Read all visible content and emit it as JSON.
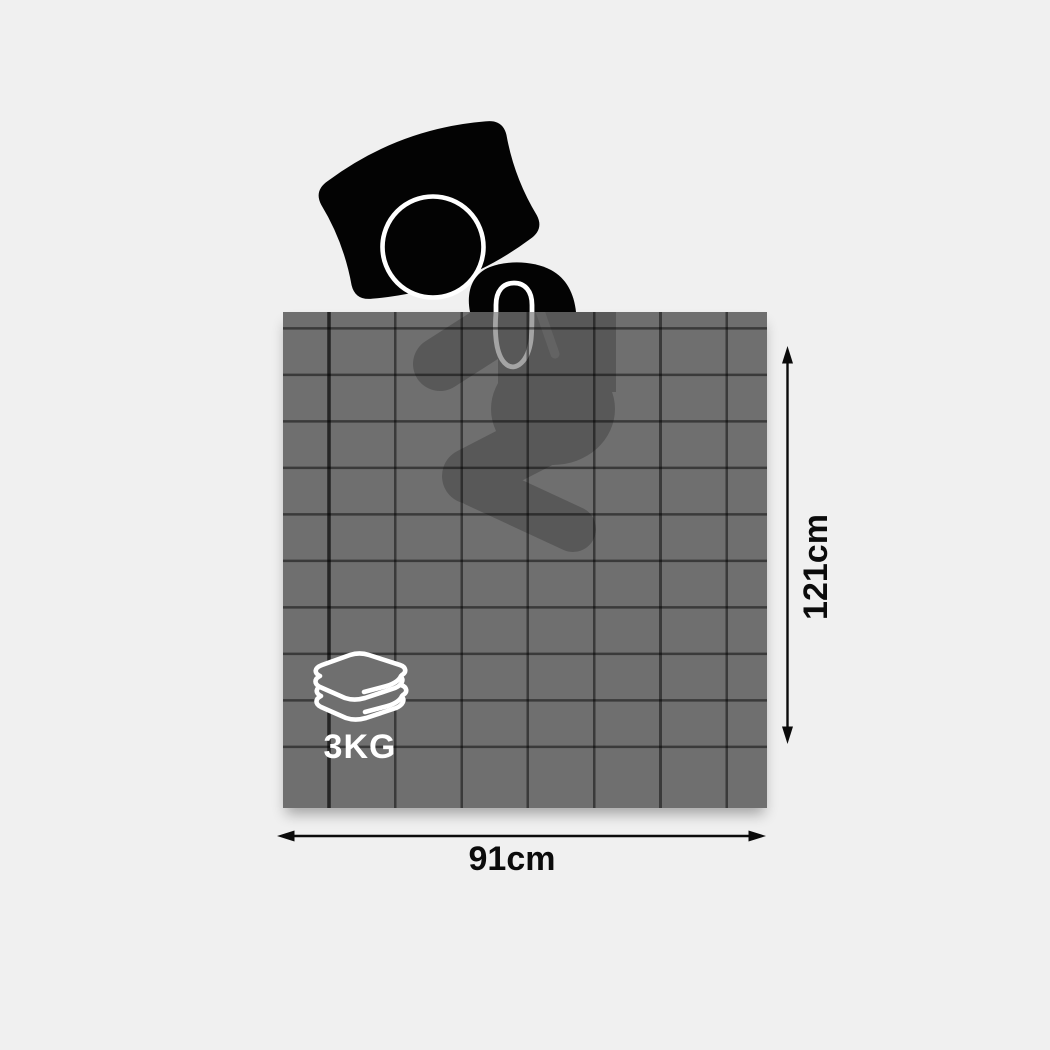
{
  "diagram": {
    "height_label": "121cm",
    "width_label": "91cm",
    "weight_label": "3KG",
    "icons": {
      "sleeping_person": "sleeping-person-icon",
      "folded_blanket": "folded-blanket-icon",
      "height_arrow": "vertical-double-arrow",
      "width_arrow": "horizontal-double-arrow"
    },
    "colors": {
      "background": "#f0f0f0",
      "blanket_base": "#6f6f6f",
      "grid_line": "#3a3a3a",
      "body_silhouette": "#595959",
      "figure_black": "#030303",
      "dimension_text": "#0b0b0b",
      "weight_text": "#ffffff",
      "icon_stroke": "#ffffff"
    }
  }
}
